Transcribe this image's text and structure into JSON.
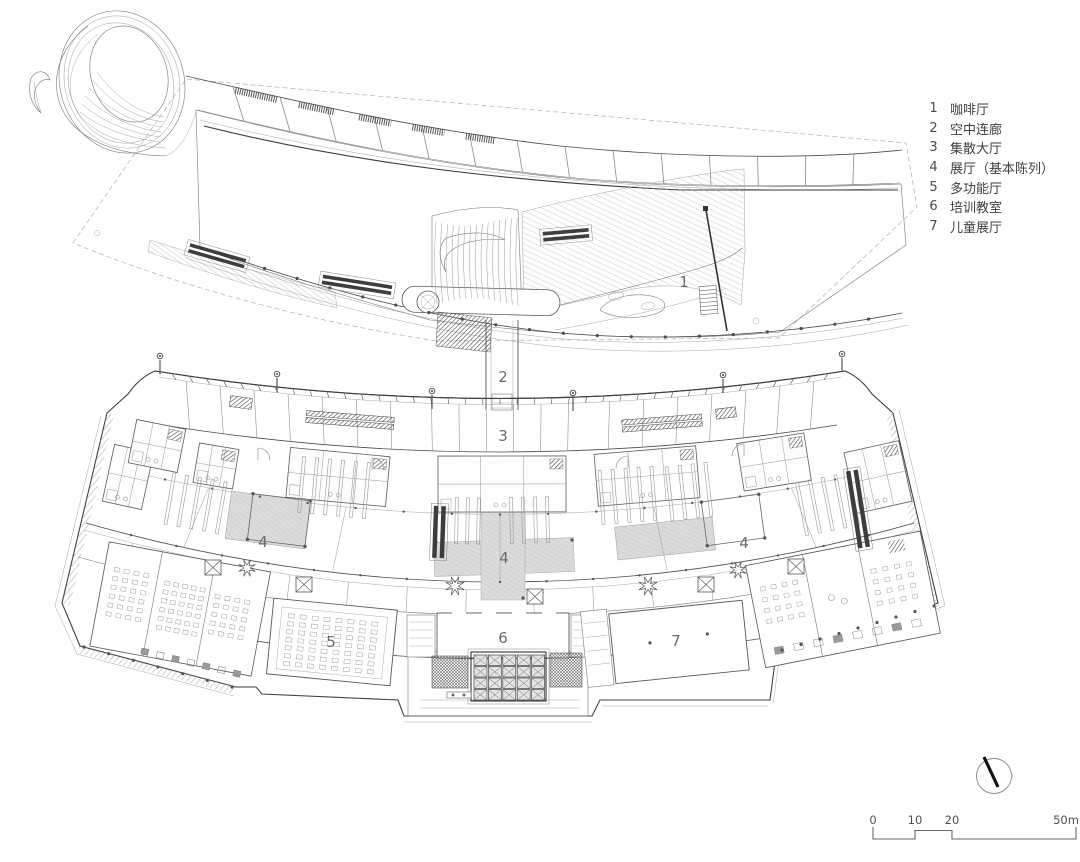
{
  "legend": {
    "items": [
      {
        "num": "1",
        "label": "咖啡厅"
      },
      {
        "num": "2",
        "label": "空中连廊"
      },
      {
        "num": "3",
        "label": "集散大厅"
      },
      {
        "num": "4",
        "label": "展厅（基本陈列）"
      },
      {
        "num": "5",
        "label": "多功能厅"
      },
      {
        "num": "6",
        "label": "培训教室"
      },
      {
        "num": "7",
        "label": "儿童展厅"
      }
    ]
  },
  "plan_labels": [
    {
      "text": "1"
    },
    {
      "text": "2"
    },
    {
      "text": "3"
    },
    {
      "text": "4"
    },
    {
      "text": "4"
    },
    {
      "text": "4"
    },
    {
      "text": "5"
    },
    {
      "text": "6"
    },
    {
      "text": "7"
    }
  ],
  "scale_bar": {
    "ticks": [
      "0",
      "10",
      "20",
      "50m"
    ]
  },
  "colors": {
    "ink": "#4a4a4a",
    "thin_line": "#9c9c9c",
    "dark_fill": "#3d3d3d",
    "patch_gray": "#dbdbdb"
  }
}
